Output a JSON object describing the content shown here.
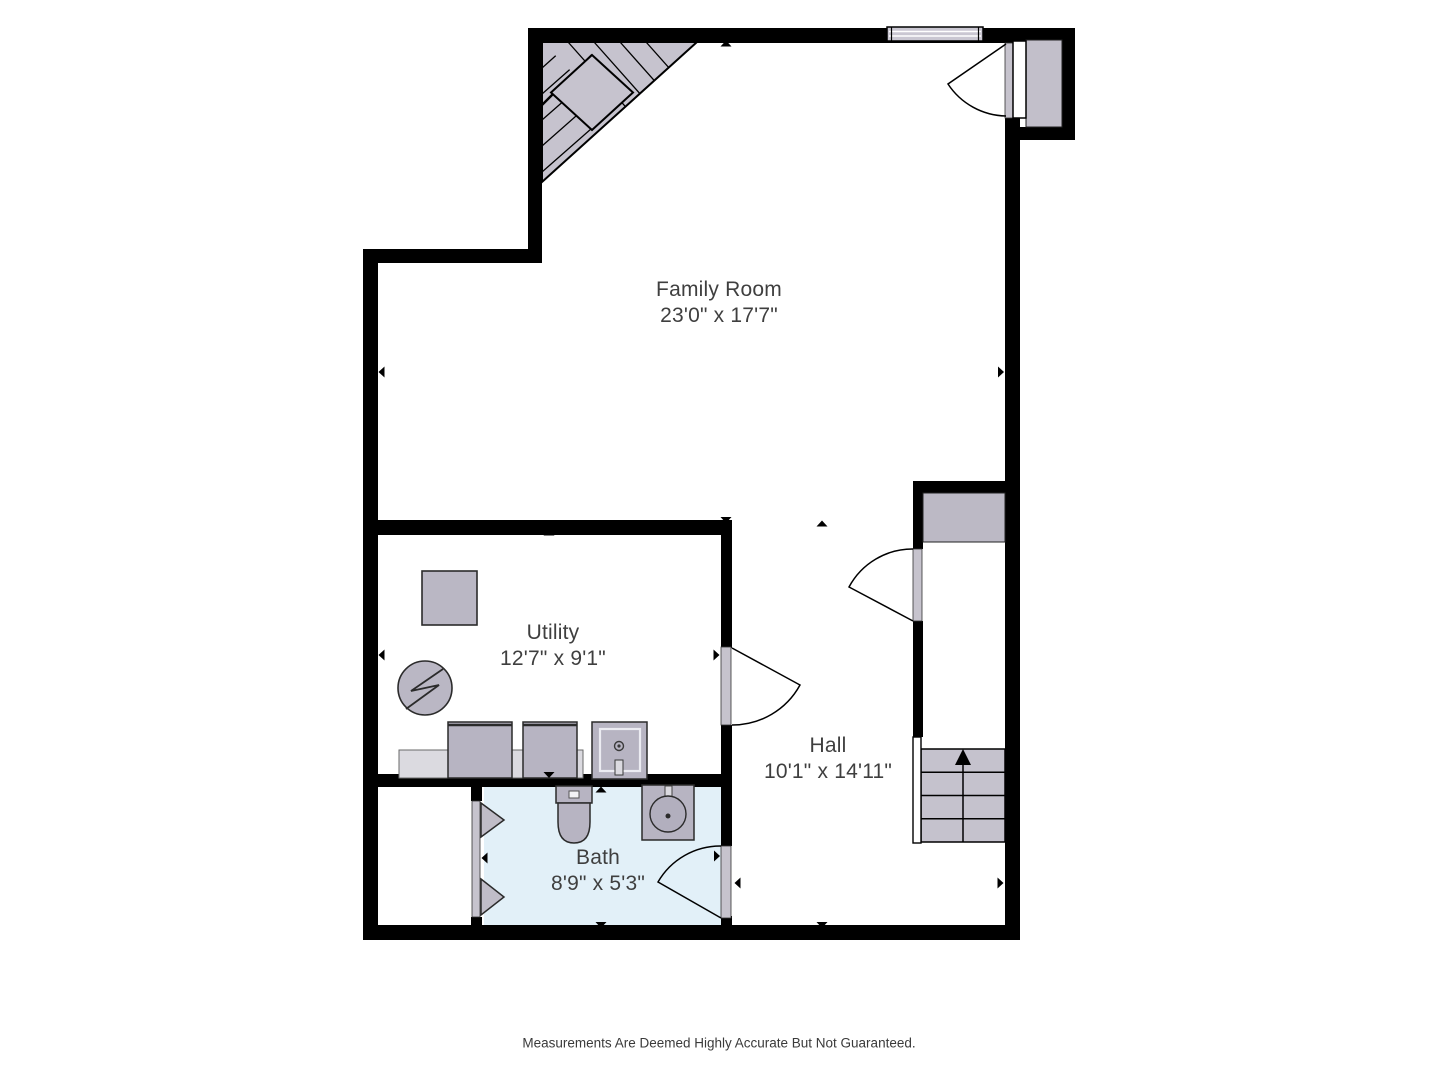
{
  "rooms": [
    {
      "name": "Family Room",
      "dimensions": "23'0\" x 17'7\""
    },
    {
      "name": "Utility",
      "dimensions": "12'7\" x 9'1\""
    },
    {
      "name": "Hall",
      "dimensions": "10'1\" x 14'11\""
    },
    {
      "name": "Bath",
      "dimensions": "8'9\" x 5'3\""
    }
  ],
  "disclaimer": "Measurements Are Deemed Highly Accurate But Not Guaranteed.",
  "features": [
    "winder-stairs",
    "window",
    "entry-door",
    "exterior-landing",
    "closet",
    "closet-shelf",
    "staircase-up",
    "stair-railing",
    "utility-door",
    "bath-door",
    "bifold-doors",
    "water-heater",
    "storage-tank",
    "counter",
    "washer",
    "dryer",
    "laundry-sink",
    "toilet",
    "sink"
  ],
  "colors": {
    "wall": "#000000",
    "floor": "#ffffff",
    "bath_floor": "#e2f0f8",
    "fixture_gray": "#bab7c4",
    "fixture_light": "#dbdae0",
    "door_jamb": "#c6c3cd",
    "label_text": "#3f3f3f"
  }
}
